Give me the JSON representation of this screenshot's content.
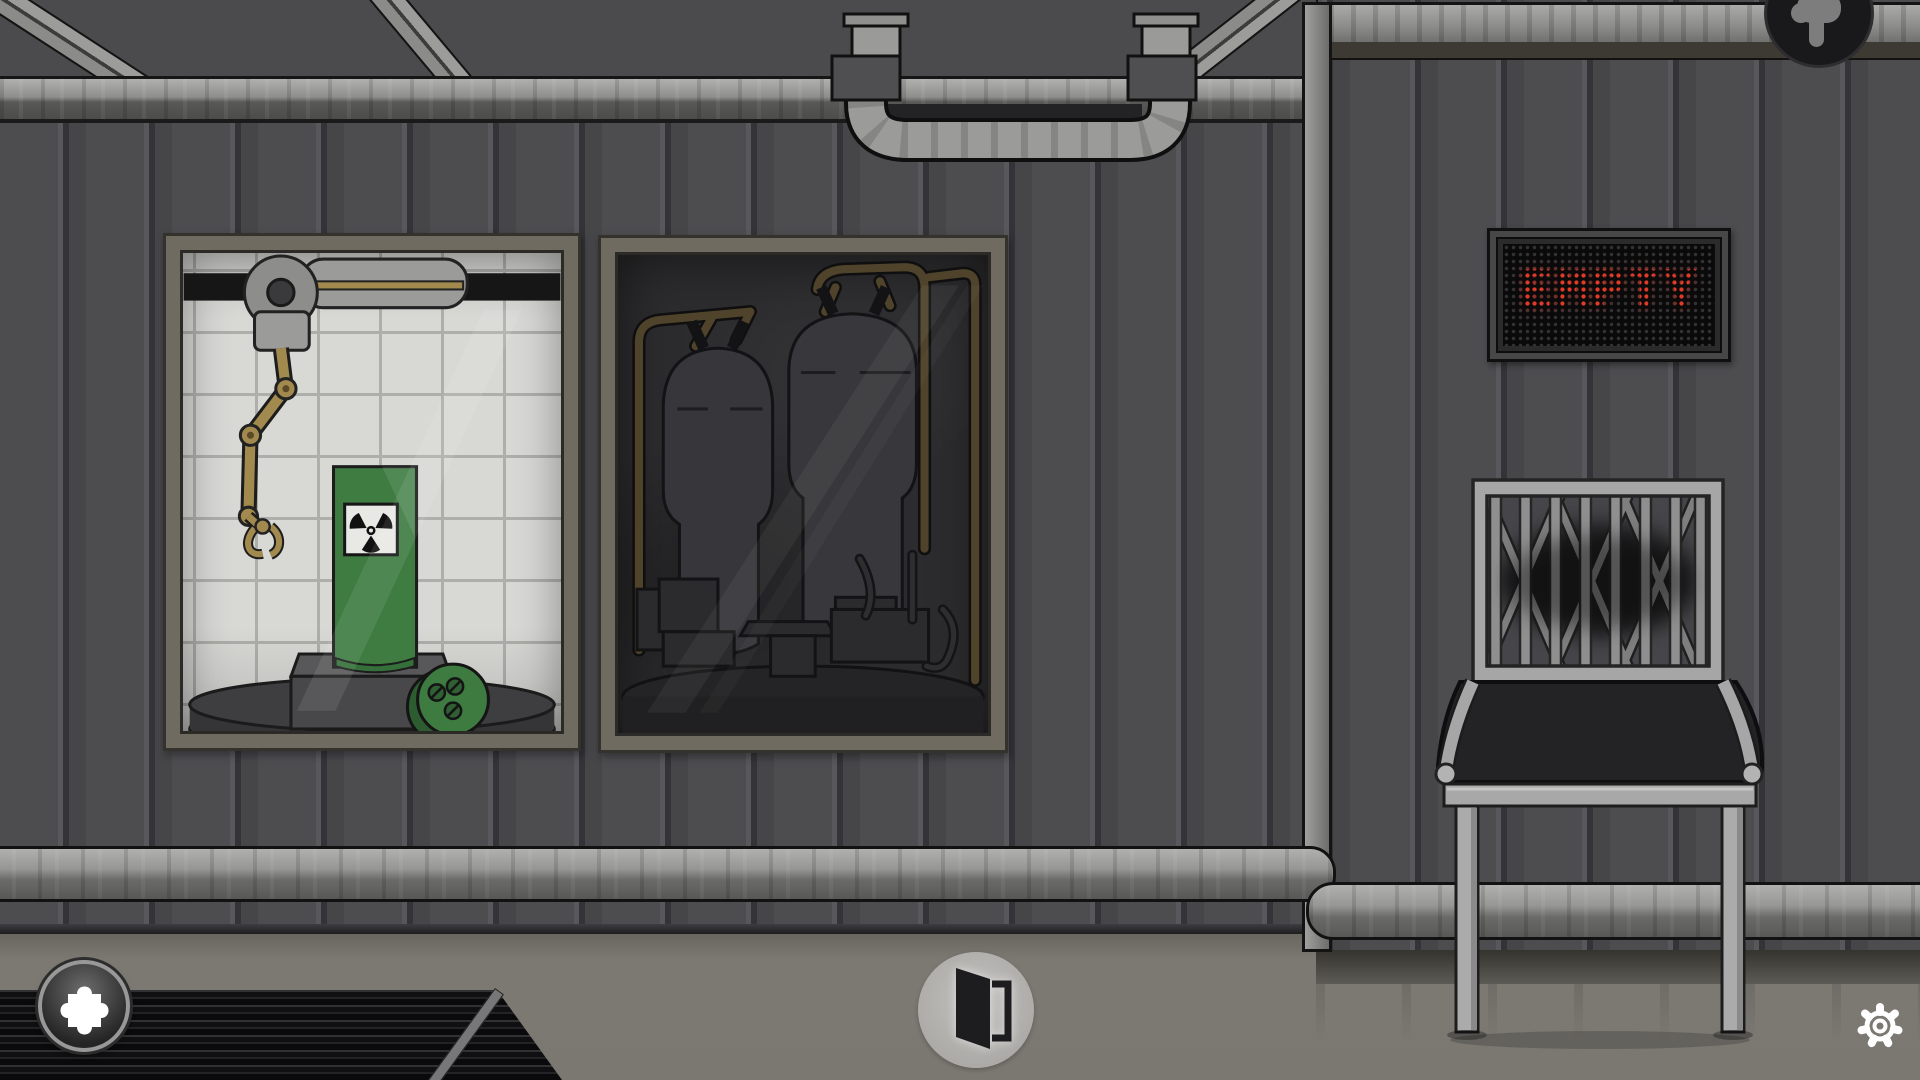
{
  "sign": {
    "text": "EMPTY",
    "led_color": "#e23a26",
    "panel_color": "#0a0a0a"
  },
  "hud": {
    "inventory_button": {
      "icon": "puzzle-piece-icon"
    },
    "exit_button": {
      "icon": "open-door-icon"
    },
    "settings_button": {
      "icon": "gear-icon"
    },
    "pointer_badge": {
      "icon": "hand-pointing-down-icon"
    }
  },
  "scene": {
    "left_window": {
      "label": "containment-window",
      "objects": [
        "robotic-arm",
        "green-canister",
        "radiation-trefoil-plaque",
        "green-screw-cap",
        "round-platform"
      ]
    },
    "right_window": {
      "label": "tank-room-window",
      "objects": [
        "pressure-tank",
        "pressure-tank",
        "brass-pipes",
        "machinery-platform"
      ]
    },
    "chair": {
      "label": "metal-lattice-chair"
    },
    "mat": {
      "label": "ribbed-floor-mat"
    },
    "pipes": {
      "top": "u-bend-overhead-pipe",
      "bottom": "wall-conduit-pipes"
    },
    "colors": {
      "wall": "#4c4c4f",
      "ceiling": "#4b4b4d",
      "floor": "#7b7872",
      "viewport_tiles": "#d8d8d5",
      "canister_green": "#3e7c42",
      "brass": "#a28a4f",
      "led_red": "#e23a26"
    }
  }
}
